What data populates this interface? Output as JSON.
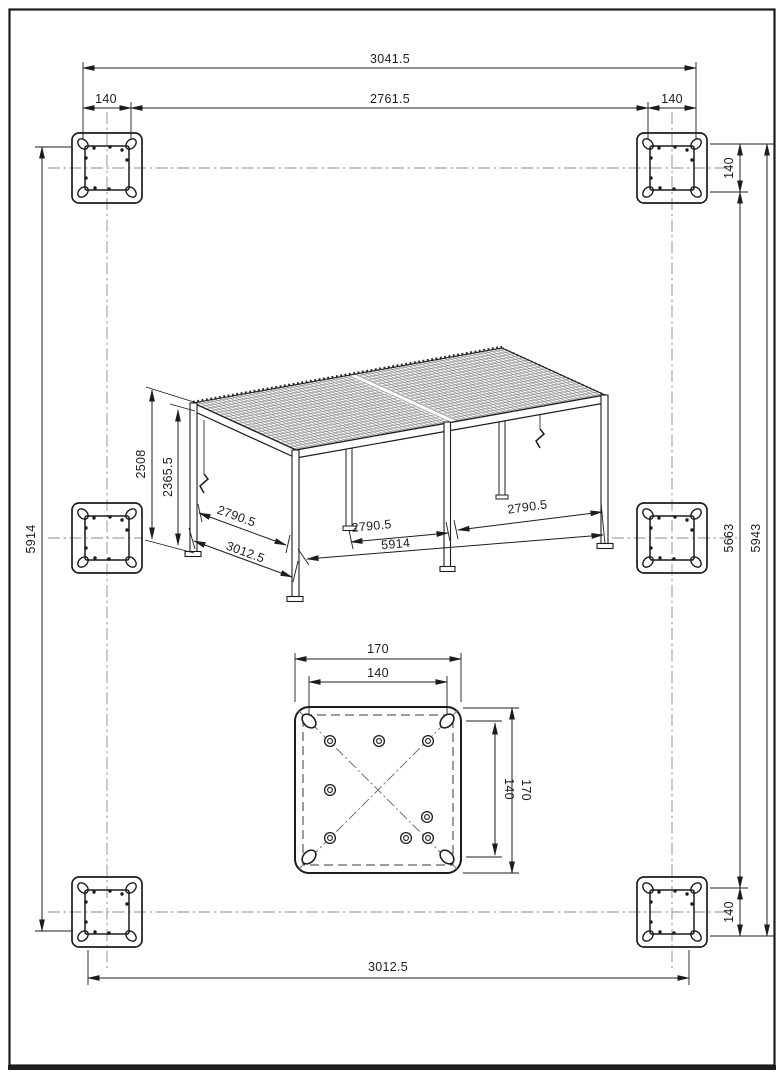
{
  "drawing": {
    "type": "technical-dimension-drawing",
    "subject": "louvered pergola foundation plan with isometric view and base plate detail",
    "background_color": "#ffffff",
    "line_color": "#1c1c1c",
    "centerline_color": "#8c8c8c"
  },
  "foundation_plan": {
    "overall_width": "3041.5",
    "inner_width": "2761.5",
    "anchor_spacing": "140",
    "length_left": "5914",
    "inner_length_right": "5663",
    "overall_length_right": "5943",
    "post_span_bottom": "3012.5",
    "footplate_count": 6
  },
  "pergola_view": {
    "overall_height": "2508",
    "clear_height": "2365.5",
    "clear_span_front": "2790.5",
    "depth": "3012.5",
    "clear_span_side": "2790.5",
    "length": "5914"
  },
  "base_plate_detail": {
    "plate_size": "170",
    "hole_spacing": "140"
  }
}
